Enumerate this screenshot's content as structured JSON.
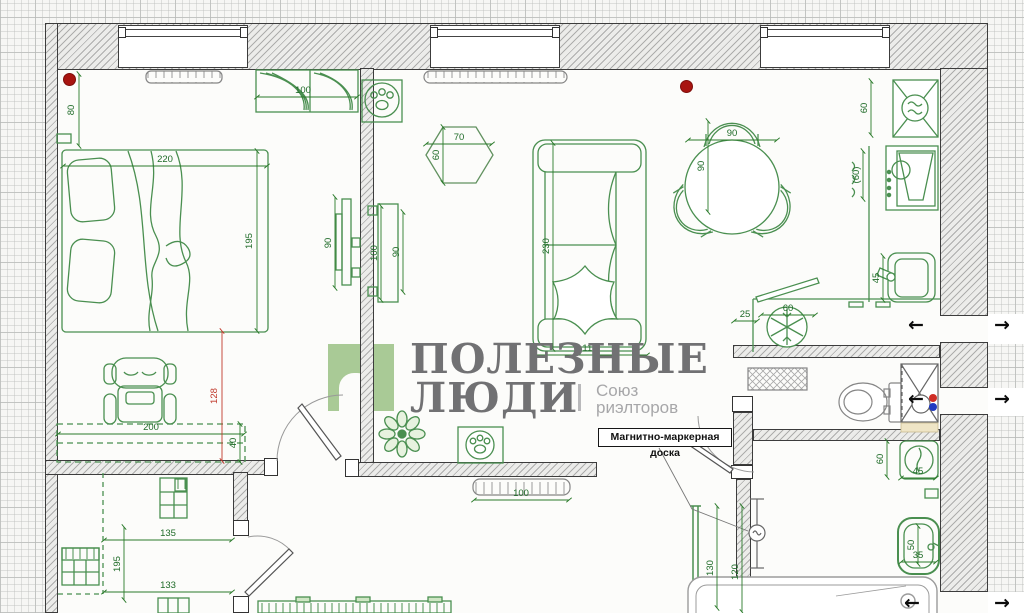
{
  "logo": {
    "title_line1": "ПОЛЕЗНЫЕ",
    "title_line2": "ЛЮДИ",
    "divider": "|",
    "subtitle_line1": "Союз",
    "subtitle_line2": "риэлторов"
  },
  "annotation": {
    "board_label": "Магнитно-маркерная доска"
  },
  "icons": {
    "arrow_left": "←",
    "arrow_right": "→"
  },
  "colors": {
    "furniture_green": "#4a8f50",
    "dimension_green": "#1f6b28",
    "dimension_red": "#c0392b",
    "logo_green": "#a9ca96",
    "logo_gray": "#717173",
    "logo_light_gray": "#a7a7a9",
    "marker_red": "#a81410",
    "dot_red": "#cf2d25",
    "dot_blue": "#2039c0"
  },
  "dimensions": [
    {
      "v": "80",
      "x": 74,
      "y": 110,
      "rot": true,
      "c": "g"
    },
    {
      "v": "220",
      "x": 165,
      "y": 162,
      "rot": false,
      "c": "g"
    },
    {
      "v": "195",
      "x": 252,
      "y": 241,
      "rot": true,
      "c": "g"
    },
    {
      "v": "100",
      "x": 303,
      "y": 93,
      "rot": false,
      "c": "g"
    },
    {
      "v": "90",
      "x": 331,
      "y": 243,
      "rot": true,
      "c": "g"
    },
    {
      "v": "200",
      "x": 151,
      "y": 430,
      "rot": false,
      "c": "g"
    },
    {
      "v": "40",
      "x": 236,
      "y": 443,
      "rot": true,
      "c": "g"
    },
    {
      "v": "128",
      "x": 217,
      "y": 396,
      "rot": true,
      "c": "r"
    },
    {
      "v": "135",
      "x": 168,
      "y": 536,
      "rot": false,
      "c": "g"
    },
    {
      "v": "195",
      "x": 120,
      "y": 564,
      "rot": true,
      "c": "g"
    },
    {
      "v": "133",
      "x": 168,
      "y": 588,
      "rot": false,
      "c": "g"
    },
    {
      "v": "70",
      "x": 459,
      "y": 140,
      "rot": false,
      "c": "g"
    },
    {
      "v": "60",
      "x": 439,
      "y": 155,
      "rot": true,
      "c": "g"
    },
    {
      "v": "100",
      "x": 377,
      "y": 253,
      "rot": true,
      "c": "g"
    },
    {
      "v": "90",
      "x": 399,
      "y": 252,
      "rot": true,
      "c": "g"
    },
    {
      "v": "230",
      "x": 549,
      "y": 246,
      "rot": true,
      "c": "g"
    },
    {
      "v": "110",
      "x": 590,
      "y": 351,
      "rot": false,
      "c": "g"
    },
    {
      "v": "90",
      "x": 732,
      "y": 136,
      "rot": false,
      "c": "g"
    },
    {
      "v": "90",
      "x": 704,
      "y": 166,
      "rot": true,
      "c": "g"
    },
    {
      "v": "100",
      "x": 521,
      "y": 496,
      "rot": false,
      "c": "g"
    },
    {
      "v": "60",
      "x": 867,
      "y": 108,
      "rot": true,
      "c": "g"
    },
    {
      "v": "(60)",
      "x": 859,
      "y": 175,
      "rot": true,
      "c": "g"
    },
    {
      "v": "45",
      "x": 879,
      "y": 278,
      "rot": true,
      "c": "g"
    },
    {
      "v": "25",
      "x": 745,
      "y": 317,
      "rot": false,
      "c": "g"
    },
    {
      "v": "60",
      "x": 788,
      "y": 311,
      "rot": false,
      "c": "g"
    },
    {
      "v": "60",
      "x": 883,
      "y": 459,
      "rot": true,
      "c": "g"
    },
    {
      "v": "45",
      "x": 918,
      "y": 474,
      "rot": false,
      "c": "g"
    },
    {
      "v": "50",
      "x": 914,
      "y": 545,
      "rot": true,
      "c": "g"
    },
    {
      "v": "35",
      "x": 918,
      "y": 558,
      "rot": false,
      "c": "g"
    },
    {
      "v": "130",
      "x": 713,
      "y": 568,
      "rot": true,
      "c": "g"
    },
    {
      "v": "120",
      "x": 738,
      "y": 572,
      "rot": true,
      "c": "g"
    }
  ]
}
